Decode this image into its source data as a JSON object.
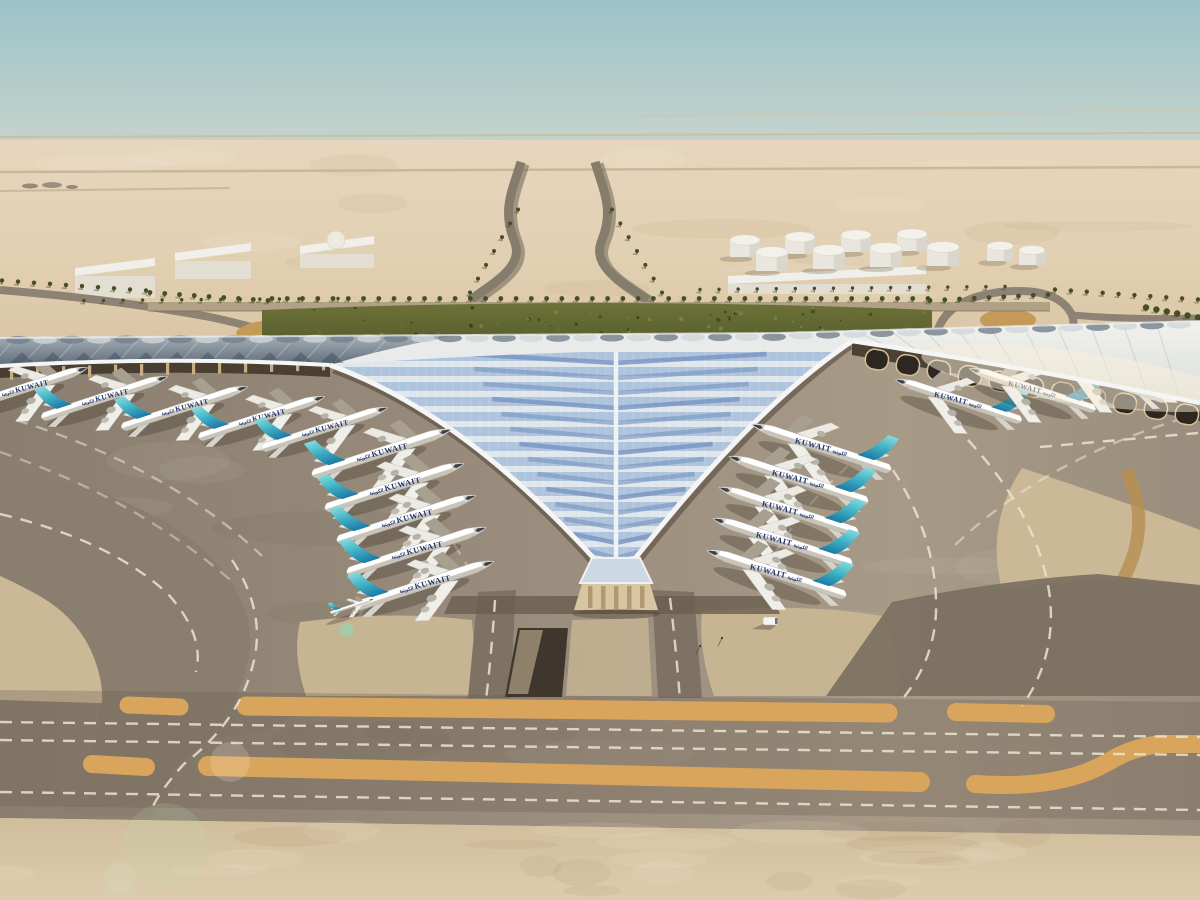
{
  "scene": {
    "description": "Aerial architectural rendering of a desert airport terminal with a trident-shaped white roof, aircraft parked at gates, taxiways and sand surroundings",
    "airline": {
      "title": "KUWAIT",
      "arabic": "الكويتية"
    },
    "colors": {
      "sky_top": "#9cc3ca",
      "sky_mid": "#c6d4cb",
      "sky_haze": "#e0d4c0",
      "horizon_sand": "#e7d6bd",
      "desert": "#e2d0b3",
      "desert_deep": "#d7c3a1",
      "sand_island": "#cbb897",
      "sand_island_warm": "#c7b492",
      "foreground_sand": "#dcccae",
      "foreground_sand_deep": "#d0bd9c",
      "apron_dark": "#8a7e6f",
      "apron": "#9a8d7d",
      "apron_light": "#a79a87",
      "taxiway": "#7b7061",
      "loop_band": "#8a7e6e",
      "connector": "#7d7264",
      "strip_orange": "#d9a55c",
      "dash_white": "#ece4d0",
      "trench": "#3f372e",
      "trench_ramp": "#8f8169",
      "road": "#8d8273",
      "road_dark": "#6e6557",
      "gold_dune": "#c59a58",
      "perimeter_road": "#b1a187",
      "hedge": "#6d7239",
      "hedge_dark": "#565c2b",
      "palm": "#445020",
      "palm_trunk": "#7d6c49",
      "roof_white": "#e9ebea",
      "roof_rim": "#f4f5f4",
      "wing_dark_top": "#a6b0b8",
      "wing_dark_bottom": "#5f6b78",
      "wing_bright_top": "#f1f2ee",
      "wing_bright_bottom": "#d9dcd8",
      "glass_blue": "#aec3dc",
      "glass_white": "#dfe7ec",
      "glass_dark": "#7b97c2",
      "spine": "#eef2f5",
      "underroof": "#3f362a",
      "column": "#c9ad83",
      "facade_dark": "#2c2720",
      "facade_frame": "#d8bf97",
      "pavilion": "#d8c5a2",
      "gable": "#ccd8e4",
      "fuselage_top": "#ffffff",
      "fuselage_bottom": "#c8c4ba",
      "fin_tip": "#86dcdd",
      "fin_mid": "#3eb0c4",
      "fin_base": "#146b9e",
      "livery": "#23356e",
      "engine": "#b6b2a8",
      "bridge": "#a79f90",
      "shadow": "rgba(60,50,38,0.32)",
      "building": "#f1efe9",
      "building_side": "#e2ded2",
      "tank": "#e9e6df",
      "tank_top": "#f3f1ea",
      "tank_shade": "#d6d2c6"
    },
    "aircraft": {
      "rotation_deg": 18,
      "title_tilt_deg": 14,
      "left_echelon": {
        "scale": 0.97,
        "positions": [
          [
            382,
            452
          ],
          [
            395,
            486
          ],
          [
            407,
            518
          ],
          [
            417,
            550
          ],
          [
            425,
            584
          ]
        ]
      },
      "right_echelon": {
        "scale": 0.97,
        "positions": [
          [
            821,
            447
          ],
          [
            798,
            479
          ],
          [
            788,
            510
          ],
          [
            782,
            541
          ],
          [
            776,
            573
          ]
        ]
      },
      "left_wing_row": {
        "scale": 0.88,
        "positions": [
          [
            25,
            388
          ],
          [
            105,
            397
          ],
          [
            185,
            407
          ],
          [
            262,
            417
          ],
          [
            325,
            428
          ]
        ]
      },
      "right_wing_row": {
        "scale": 0.88,
        "positions": [
          [
            958,
            400
          ],
          [
            1032,
            389
          ],
          [
            1103,
            379
          ],
          [
            1168,
            369
          ]
        ]
      },
      "small_apron_aircraft": [
        [
          352,
          606
        ]
      ],
      "total_count": 20
    },
    "palm_rows": [
      {
        "x1": 272,
        "y1": 299,
        "x2": 928,
        "y2": 299,
        "n": 44,
        "r": 2.4
      },
      {
        "x1": 150,
        "y1": 293,
        "x2": 268,
        "y2": 301,
        "n": 9,
        "r": 2.4
      },
      {
        "x1": 930,
        "y1": 301,
        "x2": 1048,
        "y2": 295,
        "n": 9,
        "r": 2.4
      },
      {
        "x1": 2,
        "y1": 281,
        "x2": 146,
        "y2": 291,
        "n": 10,
        "r": 2.2
      },
      {
        "x1": 1055,
        "y1": 290,
        "x2": 1198,
        "y2": 300,
        "n": 10,
        "r": 2.2
      },
      {
        "x1": 1146,
        "y1": 308,
        "x2": 1198,
        "y2": 318,
        "n": 6,
        "r": 3.2
      },
      {
        "x1": 470,
        "y1": 293,
        "x2": 518,
        "y2": 210,
        "n": 7,
        "r": 2.0
      },
      {
        "x1": 612,
        "y1": 210,
        "x2": 662,
        "y2": 293,
        "n": 7,
        "r": 2.0
      },
      {
        "x1": 84,
        "y1": 301,
        "x2": 338,
        "y2": 299,
        "n": 14,
        "r": 1.7
      },
      {
        "x1": 700,
        "y1": 290,
        "x2": 1005,
        "y2": 287,
        "n": 17,
        "r": 1.7
      }
    ],
    "tanks": [
      {
        "x": 745,
        "y": 240,
        "r": 15,
        "h": 17
      },
      {
        "x": 800,
        "y": 237,
        "r": 15,
        "h": 17
      },
      {
        "x": 856,
        "y": 235,
        "r": 15,
        "h": 17
      },
      {
        "x": 912,
        "y": 234,
        "r": 15,
        "h": 17
      },
      {
        "x": 772,
        "y": 252,
        "r": 16,
        "h": 19
      },
      {
        "x": 829,
        "y": 250,
        "r": 16,
        "h": 19
      },
      {
        "x": 886,
        "y": 248,
        "r": 16,
        "h": 19
      },
      {
        "x": 943,
        "y": 247,
        "r": 16,
        "h": 19
      },
      {
        "x": 1000,
        "y": 246,
        "r": 13,
        "h": 15
      },
      {
        "x": 1032,
        "y": 250,
        "r": 13,
        "h": 15
      }
    ],
    "buildings": [
      {
        "x": 75,
        "y": 258,
        "w": 80,
        "h": 40,
        "dome": false
      },
      {
        "x": 175,
        "y": 243,
        "w": 76,
        "h": 36,
        "dome": false
      },
      {
        "x": 300,
        "y": 236,
        "w": 74,
        "h": 32,
        "dome": true
      },
      {
        "x": 728,
        "y": 266,
        "w": 198,
        "h": 28,
        "dome": false
      }
    ],
    "vehicles": {
      "bus": [
        763,
        617
      ],
      "car": [
        283,
        314
      ],
      "poles": [
        [
          700,
          646
        ],
        [
          722,
          638
        ]
      ]
    },
    "flares": [
      {
        "x": 165,
        "y": 845,
        "r": 42,
        "c": "rgba(190,225,175,0.16)"
      },
      {
        "x": 230,
        "y": 762,
        "r": 20,
        "c": "rgba(255,246,222,0.18)"
      },
      {
        "x": 347,
        "y": 630,
        "r": 7,
        "c": "rgba(130,225,185,0.5)"
      },
      {
        "x": 120,
        "y": 878,
        "r": 16,
        "c": "rgba(210,235,200,0.2)"
      }
    ]
  }
}
